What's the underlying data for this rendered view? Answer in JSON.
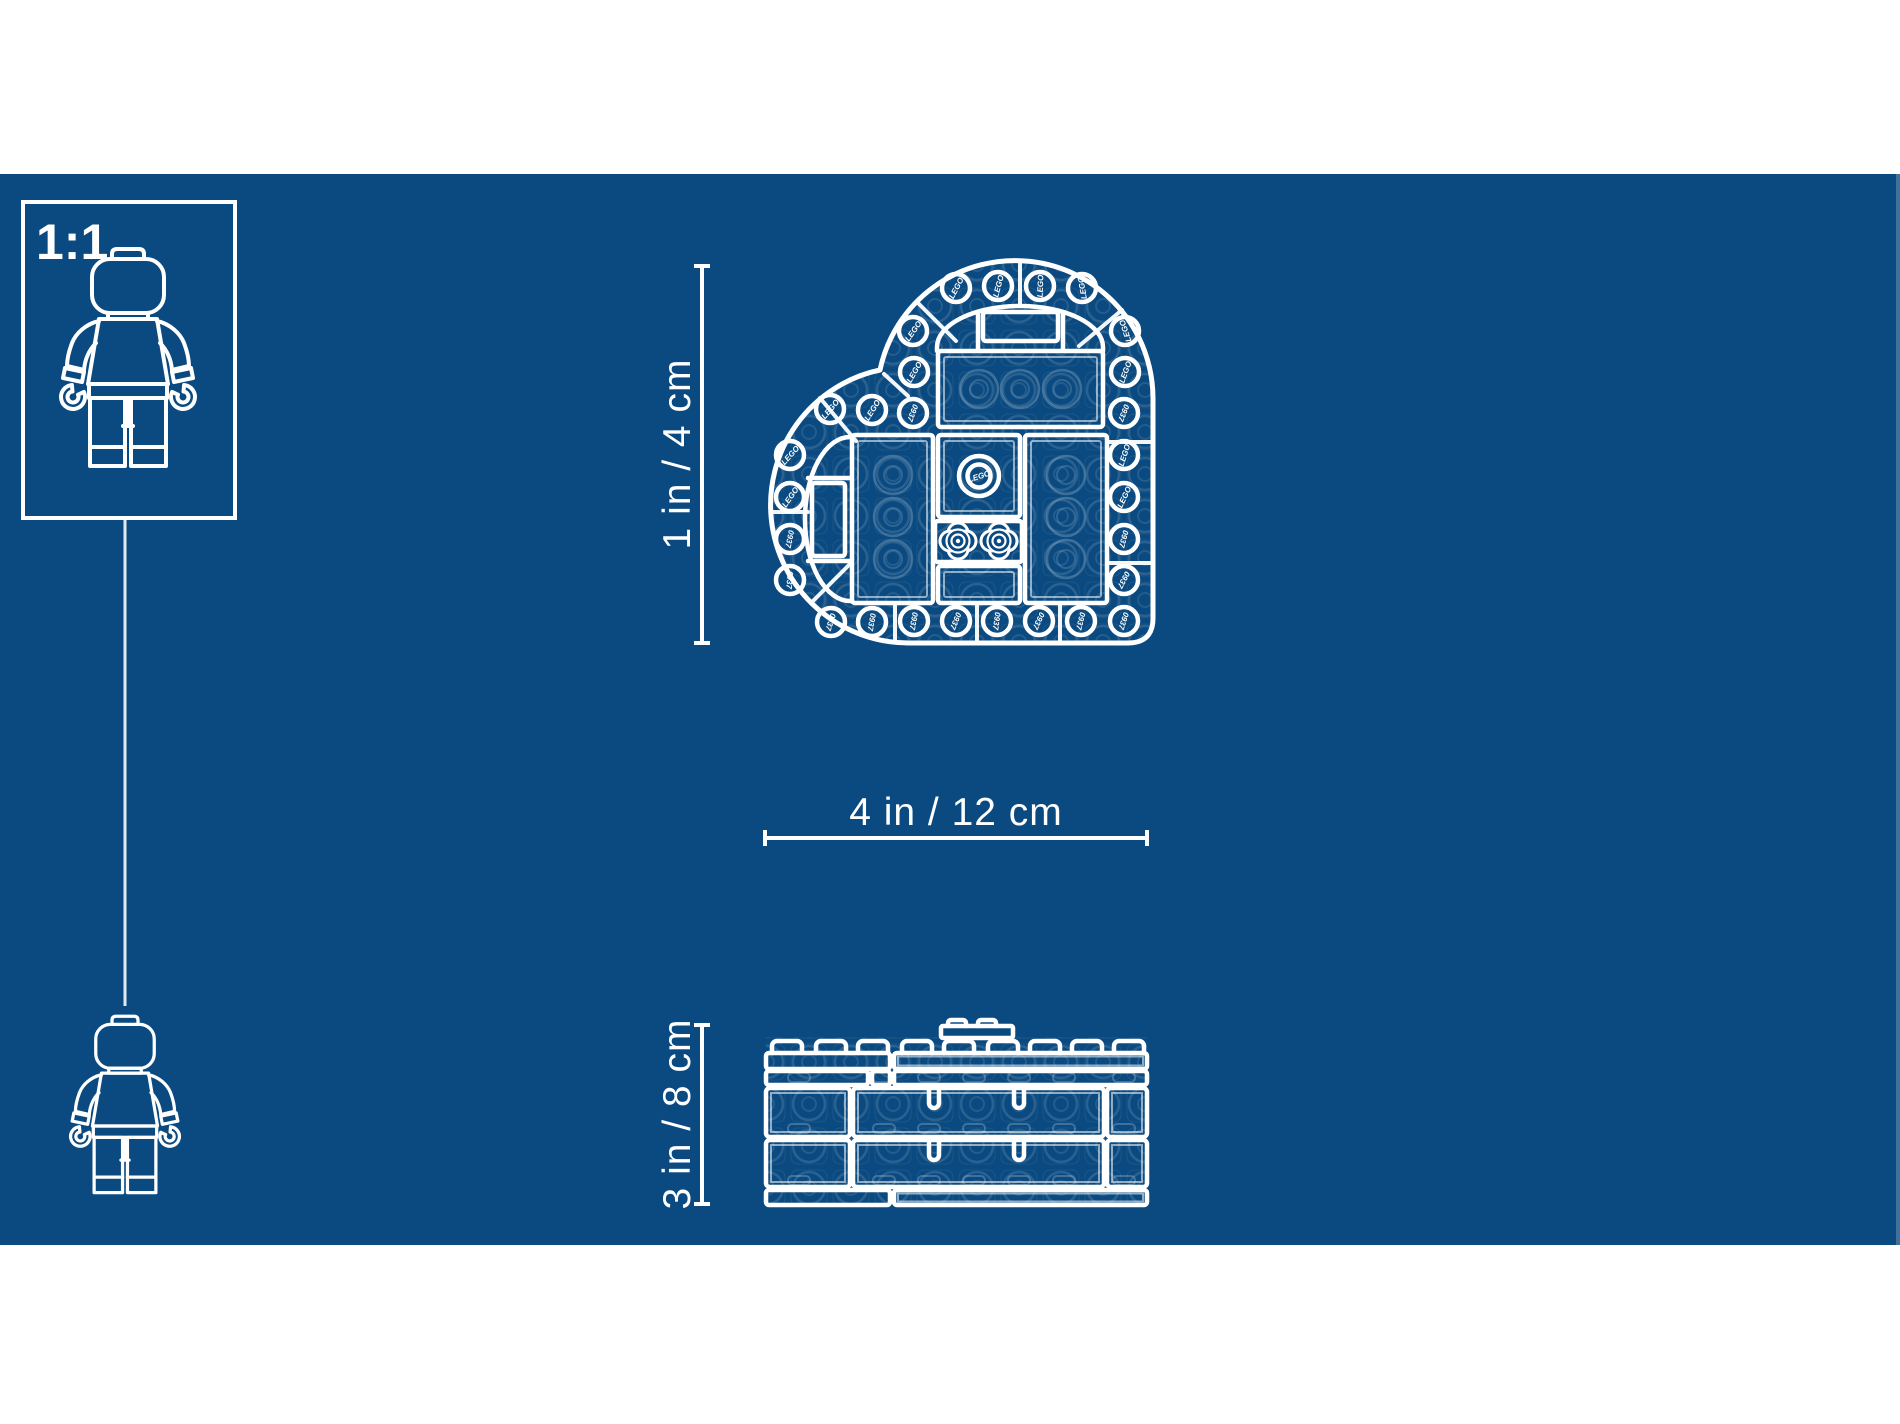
{
  "colors": {
    "page_bg": "#ffffff",
    "blueprint_bg": "#0A4A80",
    "line": "#ffffff"
  },
  "scale_box": {
    "label": "1:1"
  },
  "dimension_labels": {
    "top_view_height": "1 in / 4 cm",
    "top_view_width": "4 in / 12 cm",
    "side_view_height": "3 in / 8 cm"
  },
  "heart_top_view": {
    "studs": [
      {
        "x": 956,
        "y": 288,
        "t": "LEGO",
        "r": -62
      },
      {
        "x": 998,
        "y": 286,
        "t": "LEGO",
        "r": -75
      },
      {
        "x": 1040,
        "y": 286,
        "t": "LEGO",
        "r": -88
      },
      {
        "x": 1082,
        "y": 288,
        "t": "LEGO",
        "r": -100
      },
      {
        "x": 913,
        "y": 331,
        "t": "LEGO",
        "r": -55
      },
      {
        "x": 914,
        "y": 372,
        "t": "LEGO",
        "r": -60
      },
      {
        "x": 1125,
        "y": 331,
        "t": "LEGO",
        "r": -108
      },
      {
        "x": 1125,
        "y": 372,
        "t": "LEGO",
        "r": -70
      },
      {
        "x": 1124,
        "y": 413,
        "t": "0937",
        "r": 112
      },
      {
        "x": 1124,
        "y": 455,
        "t": "LEGO",
        "r": -72
      },
      {
        "x": 1124,
        "y": 497,
        "t": "LEGO",
        "r": -65
      },
      {
        "x": 1124,
        "y": 539,
        "t": "0937",
        "r": 105
      },
      {
        "x": 1124,
        "y": 580,
        "t": "0937",
        "r": 118
      },
      {
        "x": 1124,
        "y": 621,
        "t": "0937",
        "r": 108
      },
      {
        "x": 914,
        "y": 621,
        "t": "0937",
        "r": 100
      },
      {
        "x": 956,
        "y": 621,
        "t": "0937",
        "r": 112
      },
      {
        "x": 997,
        "y": 621,
        "t": "0937",
        "r": 98
      },
      {
        "x": 1039,
        "y": 621,
        "t": "0937",
        "r": 115
      },
      {
        "x": 1081,
        "y": 621,
        "t": "0937",
        "r": 104
      },
      {
        "x": 830,
        "y": 409,
        "t": "LEGO",
        "r": -50
      },
      {
        "x": 872,
        "y": 410,
        "t": "LEGO",
        "r": -58
      },
      {
        "x": 913,
        "y": 413,
        "t": "0937",
        "r": 110
      },
      {
        "x": 790,
        "y": 455,
        "t": "LEGO",
        "r": -48
      },
      {
        "x": 790,
        "y": 497,
        "t": "LEGO",
        "r": -55
      },
      {
        "x": 790,
        "y": 539,
        "t": "0937",
        "r": 102
      },
      {
        "x": 790,
        "y": 580,
        "t": "0937",
        "r": 95
      },
      {
        "x": 831,
        "y": 622,
        "t": "0937",
        "r": 108
      },
      {
        "x": 872,
        "y": 622,
        "t": "0937",
        "r": 100
      }
    ],
    "ghost_flowers": [
      {
        "x": 979,
        "y": 389
      },
      {
        "x": 1020,
        "y": 389
      },
      {
        "x": 1062,
        "y": 389
      },
      {
        "x": 893,
        "y": 475
      },
      {
        "x": 893,
        "y": 517
      },
      {
        "x": 893,
        "y": 559
      },
      {
        "x": 1066,
        "y": 475
      },
      {
        "x": 1066,
        "y": 517
      },
      {
        "x": 1066,
        "y": 559
      }
    ],
    "center_stud_label": "LEGO"
  },
  "side_view": {
    "top_studs": [
      772,
      816,
      858,
      902,
      944,
      988,
      1030,
      1072,
      1114
    ],
    "raised_studs": [
      948,
      978
    ],
    "ghost_rows": [
      {
        "y": 1073,
        "xs": [
          788,
          873,
          918,
          963,
          1008,
          1053,
          1113
        ]
      },
      {
        "y": 1124,
        "xs": [
          788,
          873,
          918,
          963,
          1008,
          1053,
          1113
        ]
      },
      {
        "y": 1176,
        "xs": [
          788,
          873,
          918,
          963,
          1008,
          1053,
          1113
        ]
      }
    ]
  }
}
